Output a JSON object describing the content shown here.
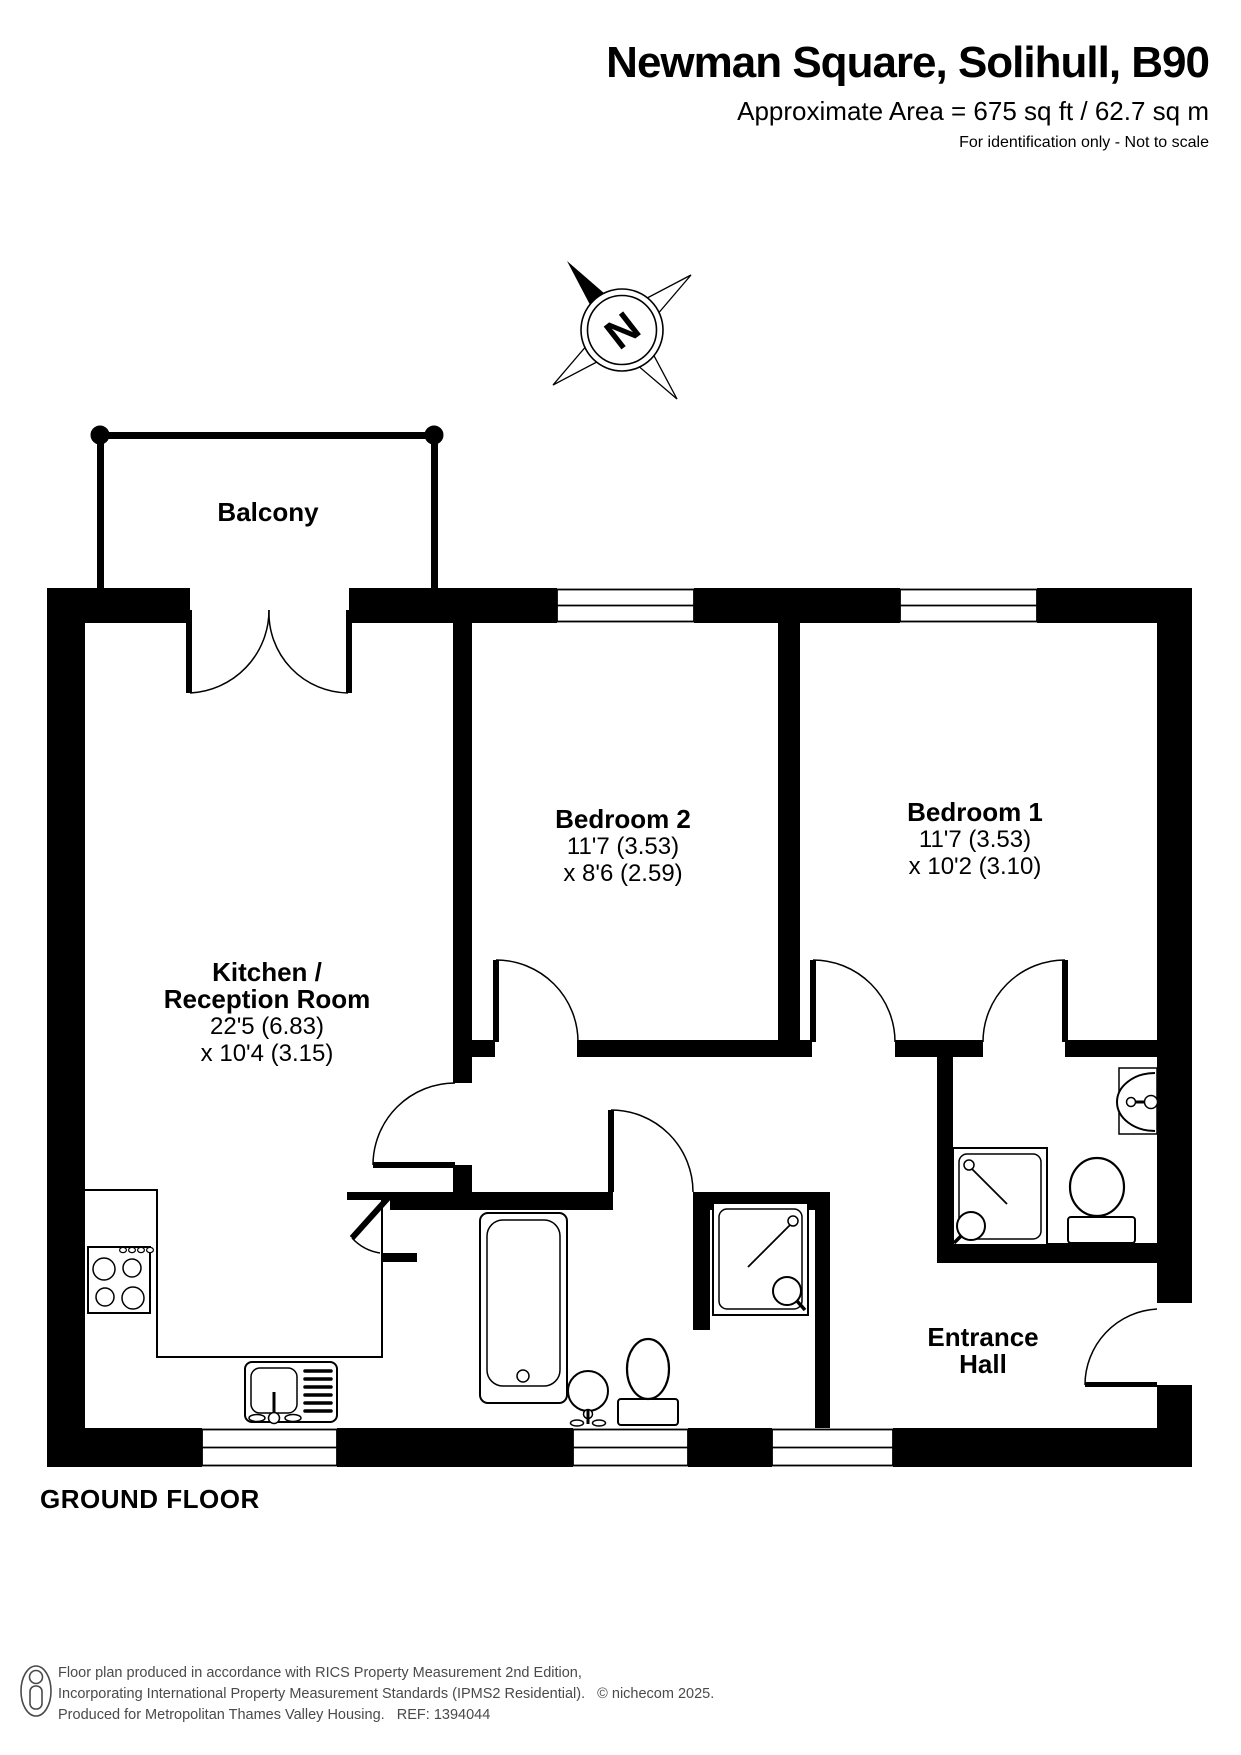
{
  "header": {
    "title": "Newman Square, Solihull, B90",
    "area": "Approximate Area = 675 sq ft / 62.7 sq m",
    "note": "For identification only - Not to scale"
  },
  "compass": {
    "north_label": "N"
  },
  "rooms": {
    "balcony": {
      "name": "Balcony"
    },
    "kitchen": {
      "name_line1": "Kitchen /",
      "name_line2": "Reception Room",
      "dims1": "22'5 (6.83)",
      "dims2": "x 10'4 (3.15)"
    },
    "bedroom2": {
      "name": "Bedroom 2",
      "dims1": "11'7 (3.53)",
      "dims2": "x 8'6 (2.59)"
    },
    "bedroom1": {
      "name": "Bedroom 1",
      "dims1": "11'7 (3.53)",
      "dims2": "x 10'2 (3.10)"
    },
    "entrance_hall": {
      "name_line1": "Entrance",
      "name_line2": "Hall"
    }
  },
  "floor_label": "GROUND FLOOR",
  "footer": {
    "line1": "Floor plan produced in accordance with RICS Property Measurement 2nd Edition,",
    "line2": "Incorporating International Property Measurement Standards (IPMS2 Residential).   © nichecom 2025.",
    "line3": "Produced for Metropolitan Thames Valley Housing.   REF: 1394044"
  },
  "fixtures": [
    "hob",
    "kitchen-sink",
    "bath",
    "pedestal-basin",
    "toilet",
    "shower-tray",
    "ensuite-shower-tray",
    "ensuite-toilet",
    "ensuite-wall-basin"
  ],
  "colors": {
    "walls": "#000000",
    "text": "#000000",
    "footer_text": "#4a4a4a",
    "background": "#ffffff"
  }
}
